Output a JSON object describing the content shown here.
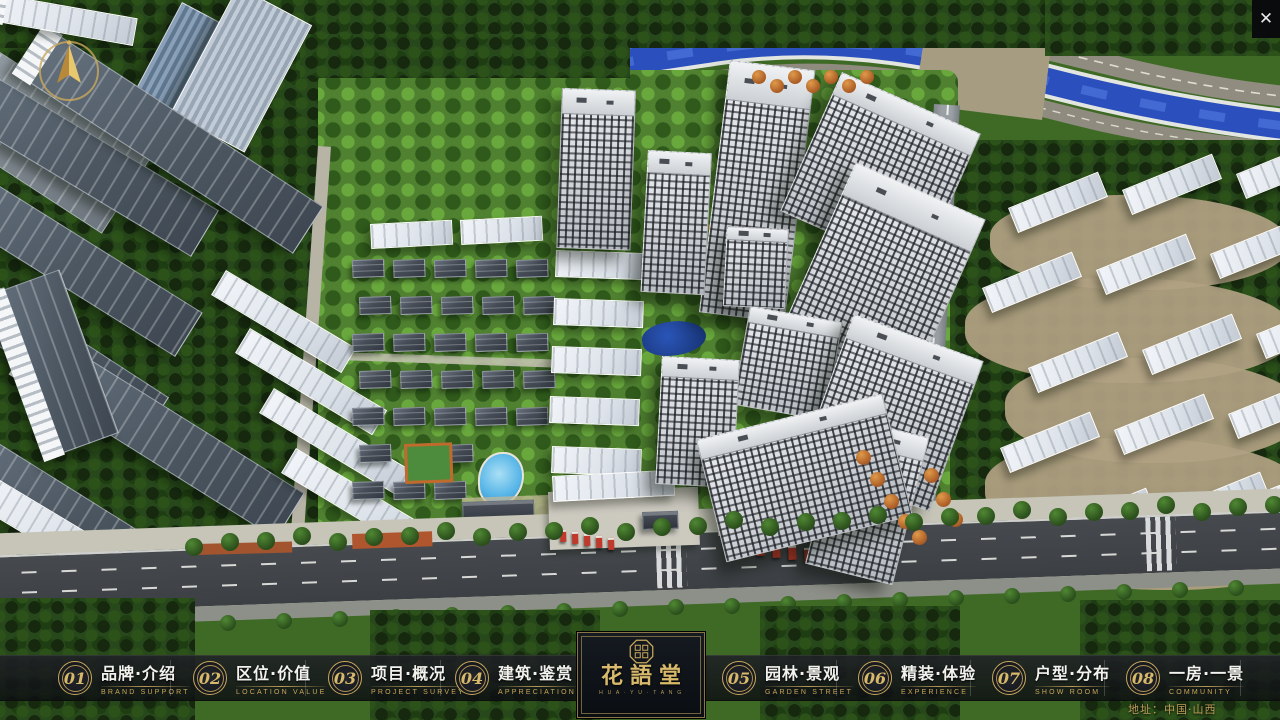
{
  "nav": {
    "items": [
      {
        "number": "01",
        "title": "品牌·介绍",
        "subtitle": "BRAND SUPPORT"
      },
      {
        "number": "02",
        "title": "区位·价值",
        "subtitle": "LOCATION VALUE"
      },
      {
        "number": "03",
        "title": "项目·概况",
        "subtitle": "PROJECT SURVEY"
      },
      {
        "number": "04",
        "title": "建筑·鉴赏",
        "subtitle": "APPRECIATION"
      },
      {
        "number": "05",
        "title": "园林·景观",
        "subtitle": "GARDEN STREET"
      },
      {
        "number": "06",
        "title": "精装·体验",
        "subtitle": "EXPERIENCE"
      },
      {
        "number": "07",
        "title": "户型·分布",
        "subtitle": "SHOW ROOM"
      },
      {
        "number": "08",
        "title": "一房·一景",
        "subtitle": "COMMUNITY"
      }
    ]
  },
  "logo": {
    "name": "花語堂",
    "tagline": "H U A · Y U · T A N G"
  },
  "footer": {
    "address": "地址：中国·山西"
  },
  "window": {
    "close_glyph": "✕"
  },
  "icons": {
    "compass": "compass-rose",
    "close": "✕",
    "seal": "octagonal-seal"
  },
  "colors": {
    "gold": "#c9a85c",
    "bar_bg": "rgba(16,18,22,0.84)",
    "river": "#2b50bd",
    "road": "#42464a"
  }
}
